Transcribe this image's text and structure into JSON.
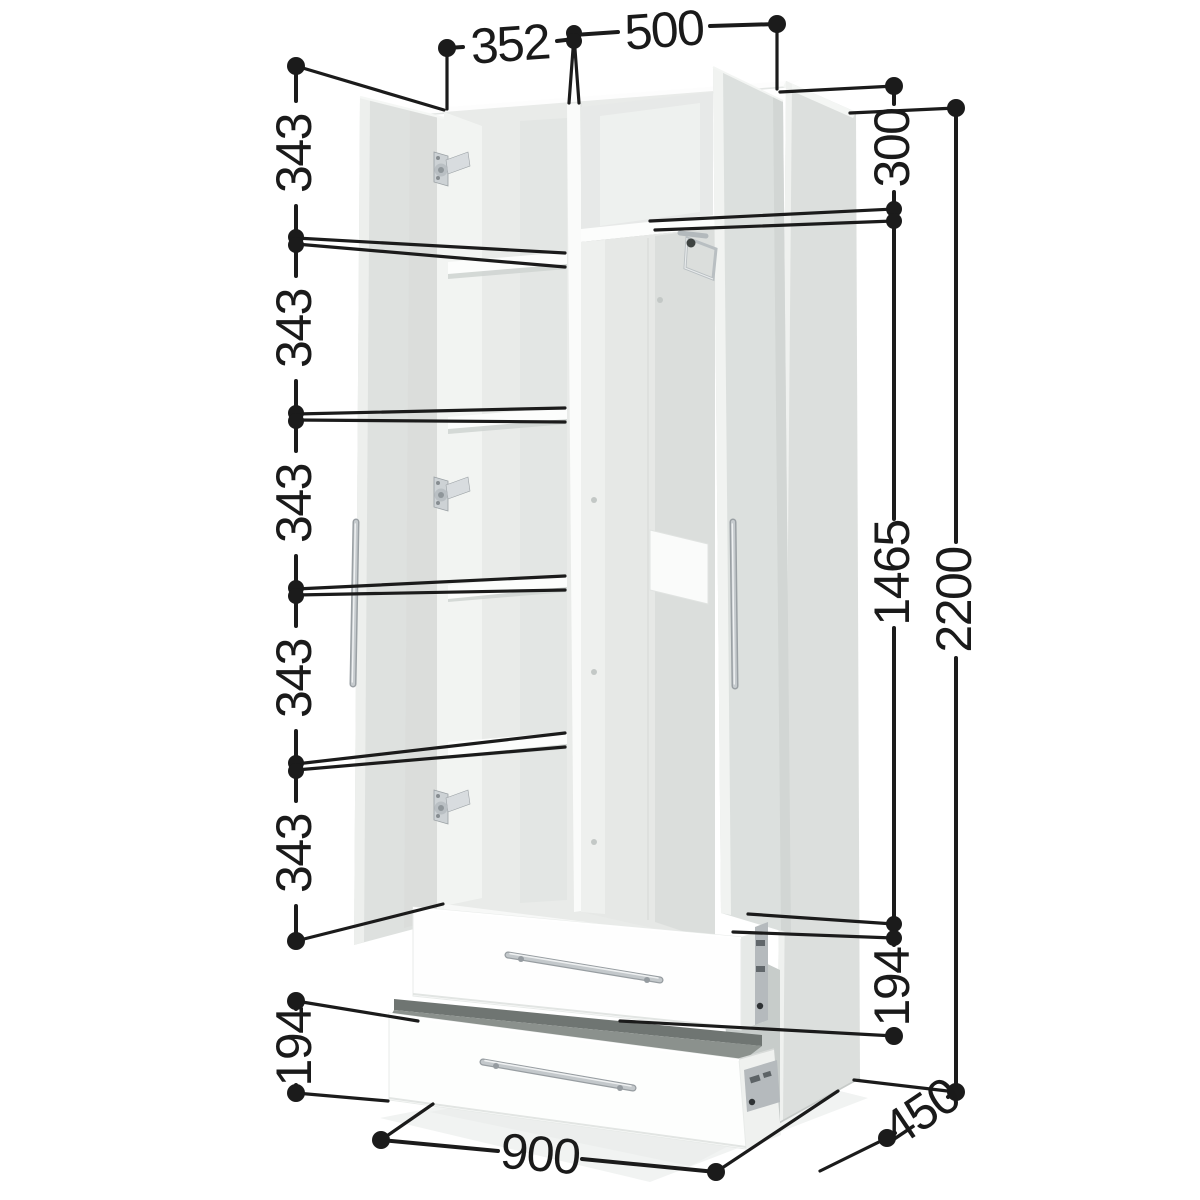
{
  "meta": {
    "description": "3D dimensional diagram of a white wardrobe with two open doors, five shelf compartments, hanging rail and two pull-out drawers"
  },
  "dimensions": {
    "top": {
      "left_section_width": "352",
      "right_section_width": "500"
    },
    "left_chain": {
      "spacings": [
        "343",
        "343",
        "343",
        "343",
        "343"
      ],
      "lower_drawer_front_height": "194"
    },
    "right_chain": {
      "top_compartment_height": "300",
      "middle_section_height": "1465",
      "upper_drawer_front_height": "194",
      "overall_height": "2200"
    },
    "bottom": {
      "overall_width": "900",
      "overall_depth": "450"
    }
  },
  "style": {
    "dimension_line_color": "#1b1b1b",
    "carcass_color": "#ffffff",
    "panel_inner_gray": "#dee1df",
    "chrome_color": "#c6cbce"
  }
}
